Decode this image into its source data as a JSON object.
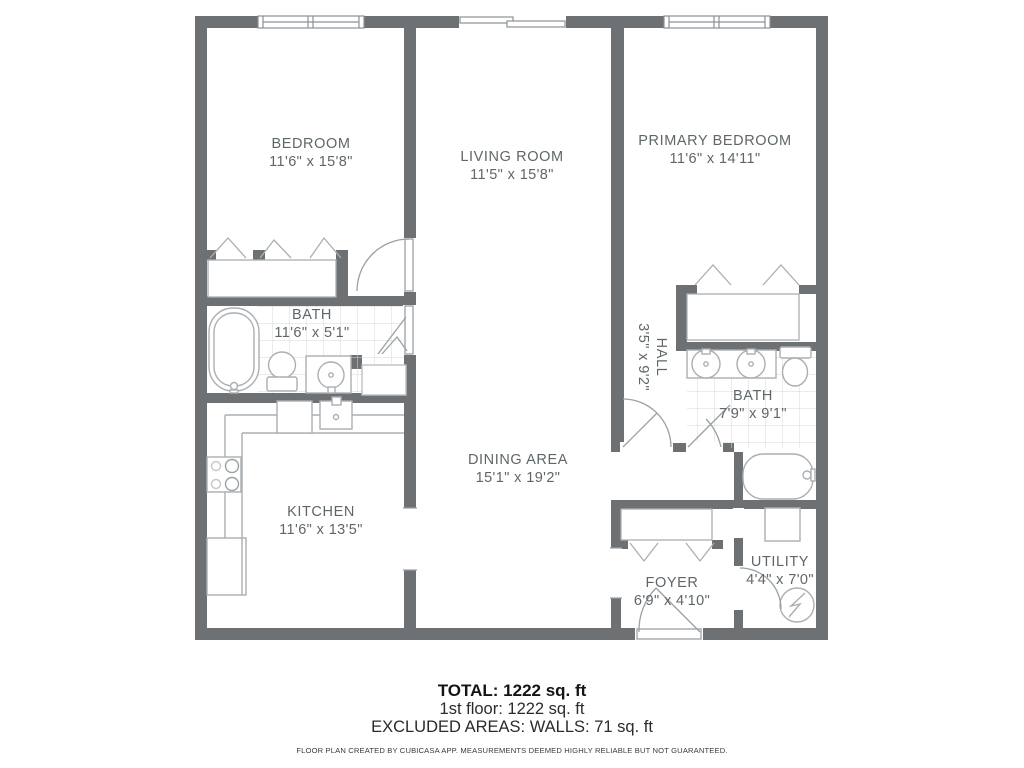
{
  "plan": {
    "rooms": [
      {
        "id": "bedroom",
        "name": "BEDROOM",
        "dims": "11'6\" x 15'8\""
      },
      {
        "id": "living-room",
        "name": "LIVING ROOM",
        "dims": "11'5\" x 15'8\""
      },
      {
        "id": "primary-bedroom",
        "name": "PRIMARY BEDROOM",
        "dims": "11'6\" x 14'11\""
      },
      {
        "id": "bath-1",
        "name": "BATH",
        "dims": "11'6\" x 5'1\""
      },
      {
        "id": "hall",
        "name": "HALL",
        "dims": "3'5\" x 9'2\""
      },
      {
        "id": "bath-2",
        "name": "BATH",
        "dims": "7'9\" x 9'1\""
      },
      {
        "id": "kitchen",
        "name": "KITCHEN",
        "dims": "11'6\" x 13'5\""
      },
      {
        "id": "dining-area",
        "name": "DINING AREA",
        "dims": "15'1\" x 19'2\""
      },
      {
        "id": "foyer",
        "name": "FOYER",
        "dims": "6'9\" x 4'10\""
      },
      {
        "id": "utility",
        "name": "UTILITY",
        "dims": "4'4\" x 7'0\""
      }
    ],
    "footer": {
      "total": "TOTAL: 1222 sq. ft",
      "floor": "1st floor: 1222 sq. ft",
      "excluded": "EXCLUDED AREAS: WALLS: 71 sq. ft",
      "disclaimer": "FLOOR PLAN CREATED BY CUBICASA APP. MEASUREMENTS DEEMED HIGHLY RELIABLE BUT NOT GUARANTEED."
    },
    "colors": {
      "wall": "#6e7174",
      "fixture_outline": "#aaafb2",
      "tile_grid": "#d4d7d9",
      "room_label_text": "#5f6669"
    }
  }
}
